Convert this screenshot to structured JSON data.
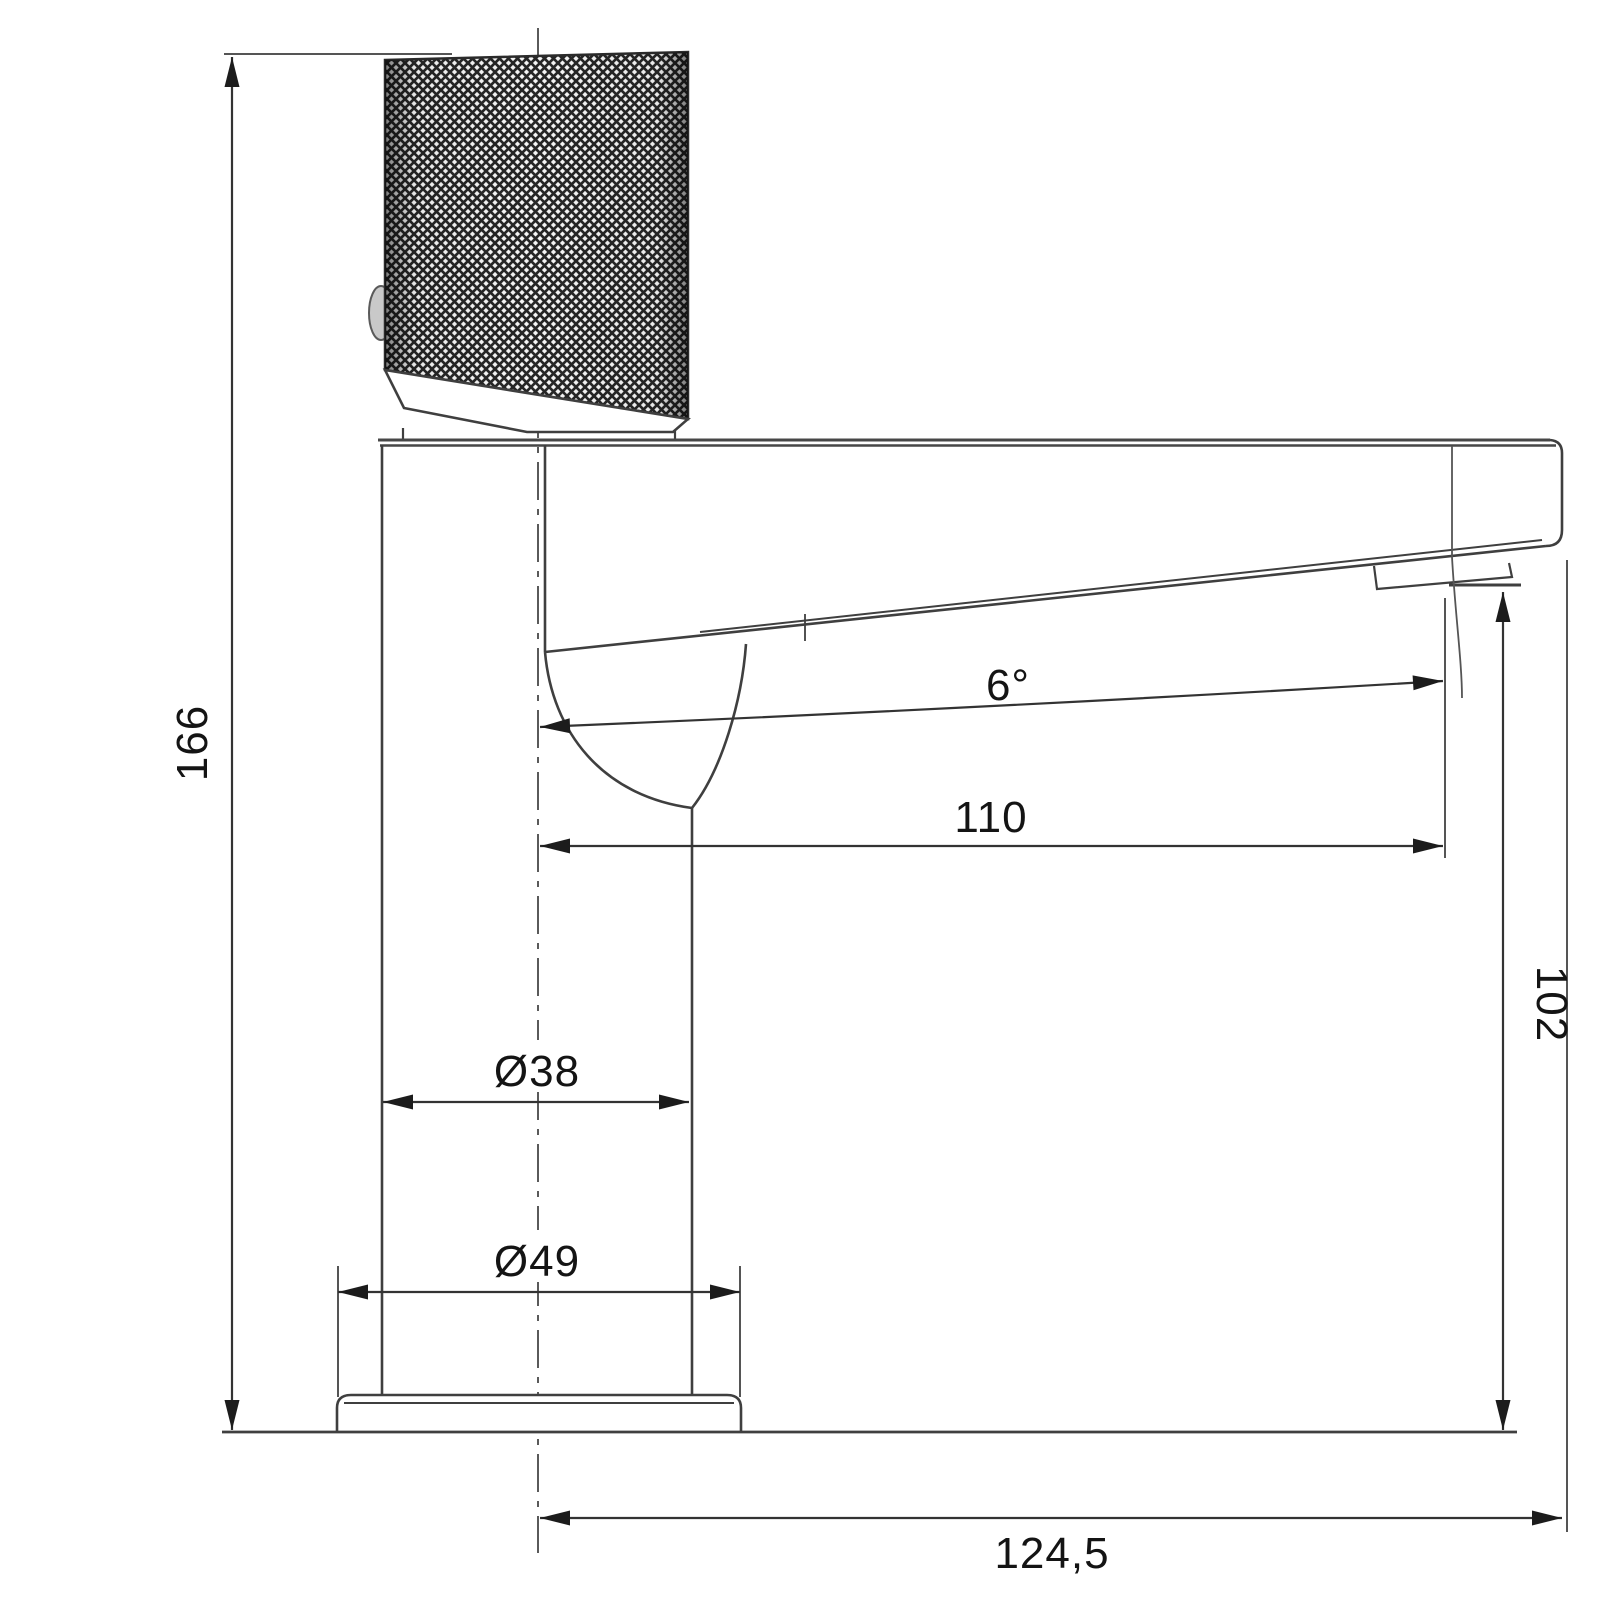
{
  "drawing": {
    "title": "basin-mixer-faucet-dimension-drawing-side-view",
    "dimensions": {
      "total_height": "166",
      "spout_reach": "110",
      "outlet_height": "102",
      "body_diameter": "Ø38",
      "base_diameter": "Ø49",
      "total_reach": "124,5",
      "spout_angle": "6°"
    },
    "colors": {
      "outline": "#3f3f3f",
      "dimension_line": "#4a4a4a",
      "text": "#141414",
      "knurl_dark": "#262626",
      "background": "#ffffff"
    }
  }
}
